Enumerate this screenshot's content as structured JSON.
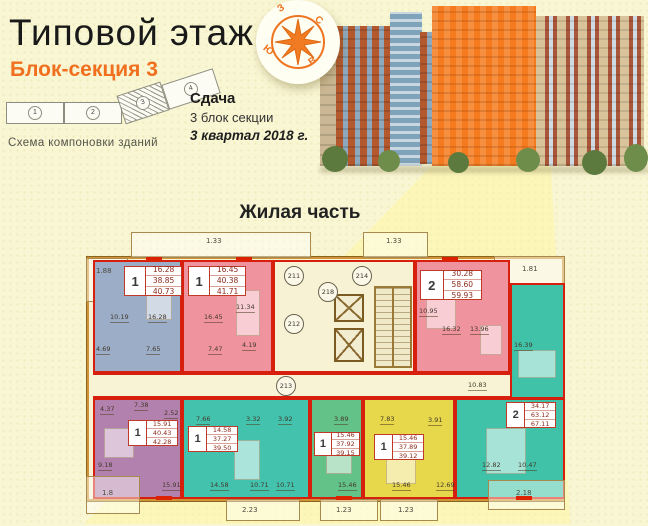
{
  "header": {
    "title": "Типовой этаж",
    "subtitle": "Блок-секция 3",
    "scheme": {
      "caption": "Схема компоновки зданий",
      "blocks": [
        "1",
        "2",
        "3",
        "4"
      ]
    },
    "delivery": {
      "label": "Сдача",
      "line1": "3 блок секции",
      "line2": "3 квартал 2018 г."
    },
    "compass": {
      "north": "С",
      "east": "В",
      "south": "Ю",
      "west": "З"
    }
  },
  "plan": {
    "title": "Жилая часть",
    "dims": {
      "top_left": "1.88",
      "balcony_top_1": "1.33",
      "balcony_top_2": "1.33",
      "top_right": "1.81",
      "bottom_left": "1.8",
      "balcony_bottom_1": "2.23",
      "balcony_bottom_2": "1.23",
      "balcony_bottom_3": "1.23",
      "bottom_right": "2.18"
    },
    "core": {
      "unit_211": "211",
      "unit_218": "218",
      "unit_212": "212",
      "unit_214": "214",
      "corridor": "213"
    },
    "apartments": [
      {
        "name": "blue-top-left",
        "type": "1",
        "living": "16.28",
        "area": "38.85",
        "total": "40.73",
        "color": "#9badc7",
        "rooms": [
          "10.19",
          "16.28",
          "4.69",
          "7.65"
        ]
      },
      {
        "name": "pink-top-1",
        "type": "1",
        "living": "16.45",
        "area": "40.38",
        "total": "41.71",
        "color": "#ef939f",
        "rooms": [
          "16.45",
          "11.34",
          "4.19",
          "7.47"
        ]
      },
      {
        "name": "pink-top-2",
        "type": "2",
        "living": "30.28",
        "area": "58.60",
        "total": "59.93",
        "color": "#ef939f",
        "rooms": [
          "10.95",
          "16.32",
          "13.96"
        ]
      },
      {
        "name": "teal-right-corner",
        "type": "2",
        "living": "34.17",
        "area": "63.12",
        "total": "67.11",
        "color": "#3fc2a7",
        "rooms": [
          "16.39",
          "10.83",
          "12.82",
          "10.47"
        ]
      },
      {
        "name": "purple-bottom-left",
        "type": "1",
        "living": "15.91",
        "area": "40.43",
        "total": "42.28",
        "color": "#b381ae",
        "rooms": [
          "7.38",
          "4.37",
          "2.52",
          "9.18",
          "15.91"
        ]
      },
      {
        "name": "teal-bottom",
        "type": "1",
        "living": "14.58",
        "area": "37.27",
        "total": "39.50",
        "color": "#43c3ad",
        "rooms": [
          "7.66",
          "3.32",
          "3.92",
          "10.71",
          "10.71",
          "14.58"
        ]
      },
      {
        "name": "green-bottom",
        "type": "1",
        "living": "15.46",
        "area": "37.92",
        "total": "39.15",
        "color": "#63c287",
        "rooms": [
          "3.89",
          "15.46"
        ]
      },
      {
        "name": "yellow-bottom",
        "type": "1",
        "living": "15.46",
        "area": "37.89",
        "total": "39.12",
        "color": "#e7d84b",
        "rooms": [
          "7.83",
          "3.91",
          "12.69",
          "15.46"
        ]
      }
    ]
  }
}
